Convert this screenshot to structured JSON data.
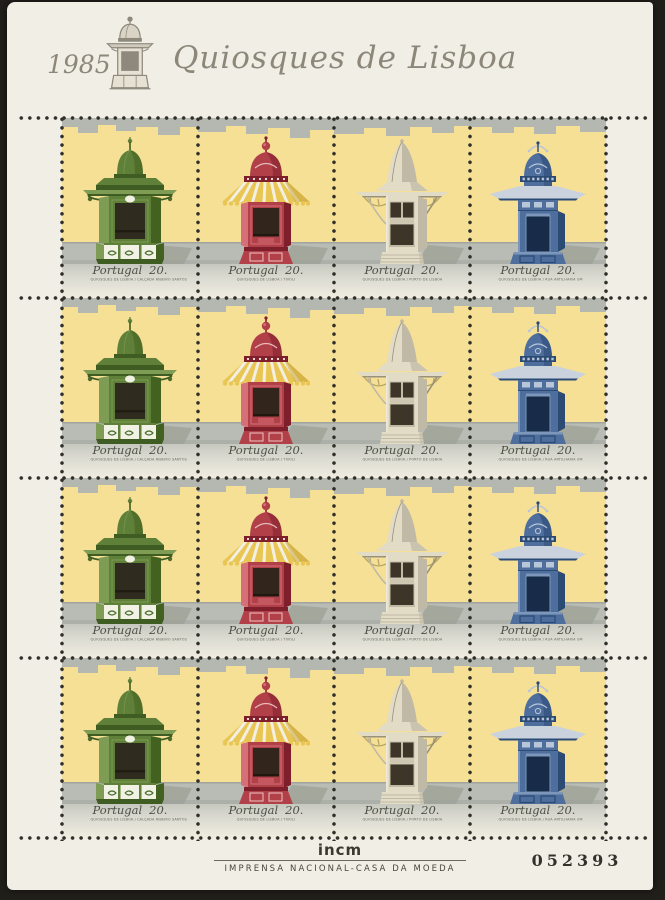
{
  "sheet": {
    "header": {
      "year": "1985",
      "title": "Quiosques de Lisboa",
      "emblem_icon": "kiosk-engraving"
    },
    "grid": {
      "rows": 4,
      "cols": 4,
      "design_order": [
        0,
        1,
        2,
        3
      ]
    },
    "designs": [
      {
        "name": "green-kiosk",
        "country": "Portugal",
        "value": "20.",
        "caption": "QUIOSQUES DE LISBOA / CALÇADA RIBEIRO SANTOS",
        "color": "#5f8038"
      },
      {
        "name": "red-kiosk",
        "country": "Portugal",
        "value": "20.",
        "caption": "QUIOSQUES DE LISBOA / TIVOLI",
        "color": "#b14049"
      },
      {
        "name": "cream-kiosk",
        "country": "Portugal",
        "value": "20.",
        "caption": "QUIOSQUES DE LISBOA / PORTO DE LISBOA",
        "color": "#e2dbc6"
      },
      {
        "name": "blue-kiosk",
        "country": "Portugal",
        "value": "20.",
        "caption": "QUIOSQUES DE LISBOA / RUA ARTILHARIA UM",
        "color": "#4e6e9d"
      }
    ],
    "footer": {
      "printer_logo": "incm",
      "imprint": "IMPRENSA NACIONAL-CASA DA MOEDA",
      "sheet_number": "052393"
    },
    "palette": {
      "paper": "#f1eee6",
      "sky_yellow": "#f5e096",
      "skyline_gray": "#b5b8b1",
      "street_gray": "#b9bcb5",
      "caption_strip": "#d8d8cf",
      "header_taupe": "#8d8779",
      "perforation_dot": "#302e29",
      "scan_background": "#211f1a"
    }
  }
}
